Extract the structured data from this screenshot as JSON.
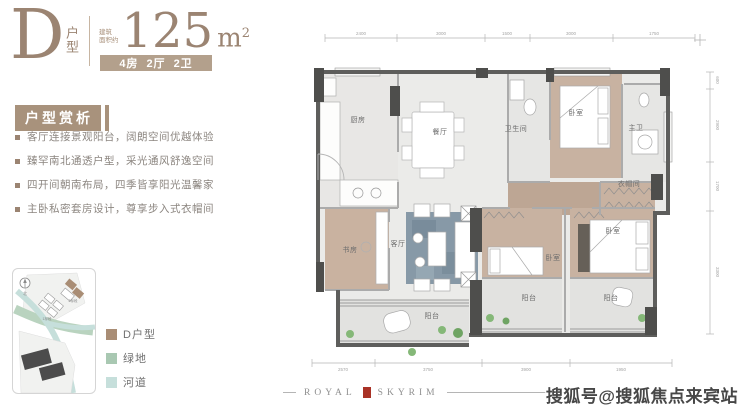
{
  "header": {
    "unit_letter": "D",
    "unit_word": "户型",
    "area_note_line1": "建筑",
    "area_note_line2": "面积约",
    "area_value": "125",
    "area_unit_m": "m",
    "area_unit_sup": "2",
    "spec_rooms": "4房",
    "spec_halls": "2厅",
    "spec_baths": "2卫"
  },
  "analysis": {
    "title": "户型赏析",
    "bullets": [
      "客厅连接景观阳台，阔朗空间优越体验",
      "臻罕南北通透户型，采光通风舒逸空间",
      "四开间朝南布局，四季皆享阳光温馨家",
      "主卧私密套房设计，尊享步入式衣帽间"
    ]
  },
  "site_map": {
    "north_label": "北",
    "phase_1_label": "1标段",
    "phase_2_label": "2标段"
  },
  "legend": {
    "items": [
      {
        "label": "D户型",
        "color": "#a98d75"
      },
      {
        "label": "绿地",
        "color": "#a9c8b2"
      },
      {
        "label": "河道",
        "color": "#c6dfdb"
      }
    ]
  },
  "floorplan": {
    "rooms": {
      "kitchen": "厨房",
      "dining": "餐厅",
      "bath": "卫生间",
      "bedroom_top": "卧室",
      "master_bath": "主卫",
      "closet": "衣帽间",
      "study": "书房",
      "living": "客厅",
      "balcony_main": "阳台",
      "bedroom_mid": "卧室",
      "balcony_mid": "阳台",
      "bedroom_right": "卧室",
      "balcony_right": "阳台"
    },
    "dims_top": [
      "2400",
      "3000",
      "1500",
      "3000",
      "1750"
    ],
    "dims_right": [
      "600",
      "2900",
      "1700",
      "3300"
    ],
    "dims_bottom": [
      "2570",
      "3750",
      "3900",
      "1950"
    ]
  },
  "footer": {
    "brand_left": "ROYAL",
    "brand_right": "SKYRIM",
    "watermark": "搜狐号@搜狐焦点来宾站"
  },
  "colors": {
    "accent": "#a8927c",
    "brand_text": "#9b8472",
    "wall": "#5e5e5c",
    "wood_floor": "#c8b2a1",
    "rug_blue": "#8799a7",
    "emblem_red": "#a93226"
  }
}
